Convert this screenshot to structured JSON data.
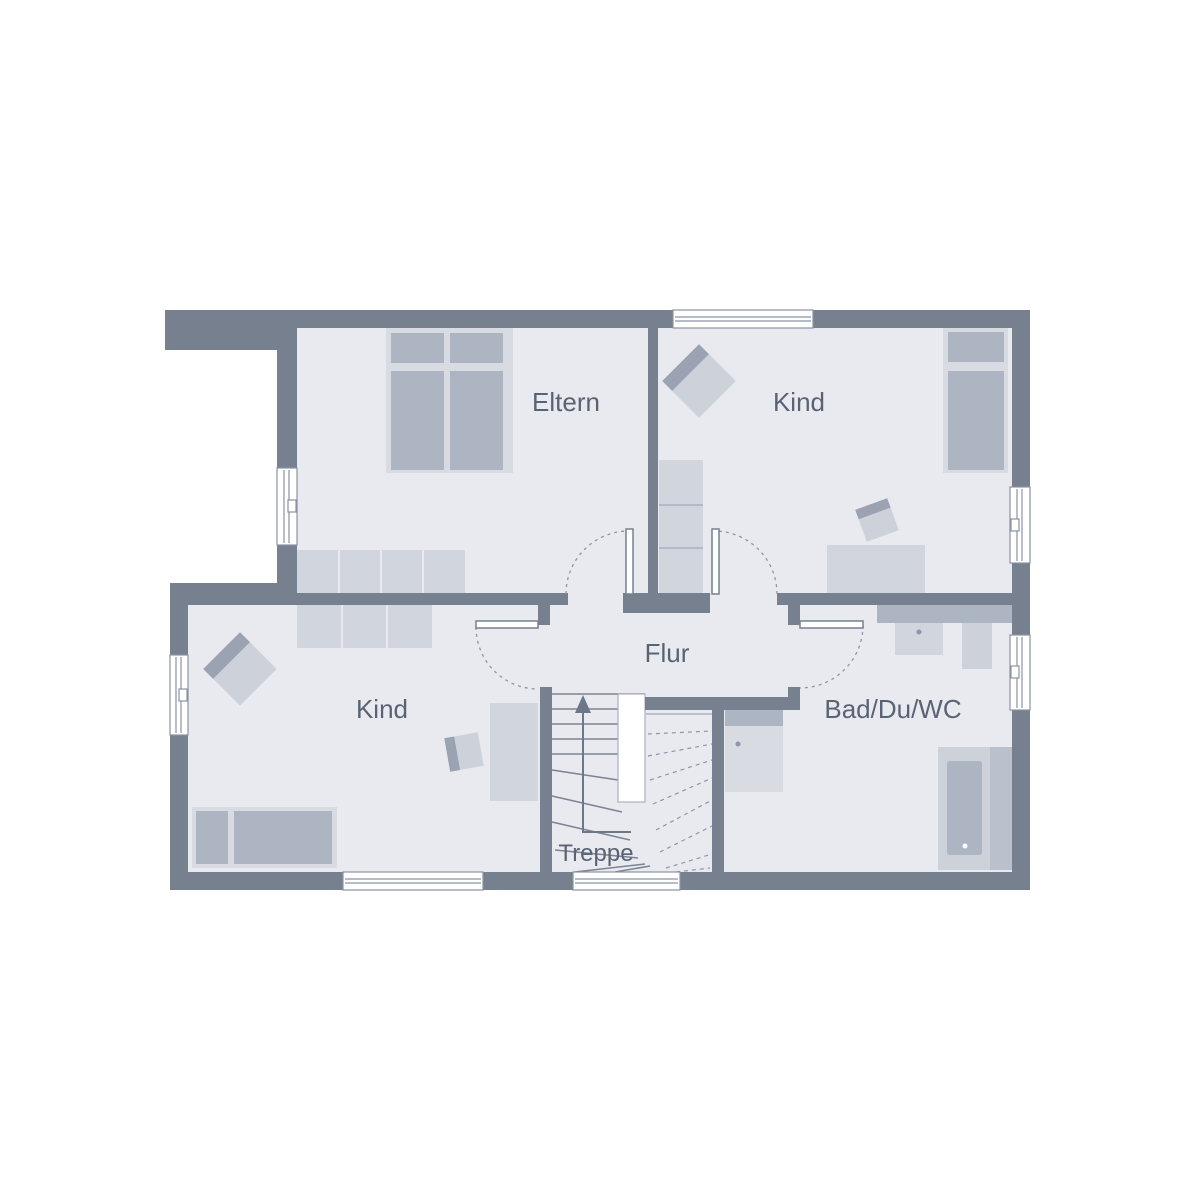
{
  "rooms": {
    "eltern": {
      "label": "Eltern"
    },
    "kind_top": {
      "label": "Kind"
    },
    "kind_bottom": {
      "label": "Kind"
    },
    "flur": {
      "label": "Flur"
    },
    "bad": {
      "label": "Bad/Du/WC"
    },
    "treppe": {
      "label": "Treppe"
    }
  },
  "icons": {
    "stair_direction_arrow": "up-arrow"
  },
  "colors": {
    "background": "#FFFFFF",
    "wall": "#76808F",
    "floor": "#E8EAEF",
    "furniture_light": "#D8DBE2",
    "furniture_soft": "#D1D5DE",
    "furniture_mid": "#CDD1DA",
    "furniture_dark": "#ADB4C2",
    "accent_stripe": "#9BA3B2",
    "counter": "#AEB5C2",
    "tub_band": "#BAC0CC",
    "window_line": "#8A93A2",
    "shelf_line": "#AAB0BD",
    "line": "#7B8494",
    "dash": "#8E96A6",
    "arrow": "#6E7787",
    "dot": "#8E96A6",
    "text": "#5A6373"
  }
}
